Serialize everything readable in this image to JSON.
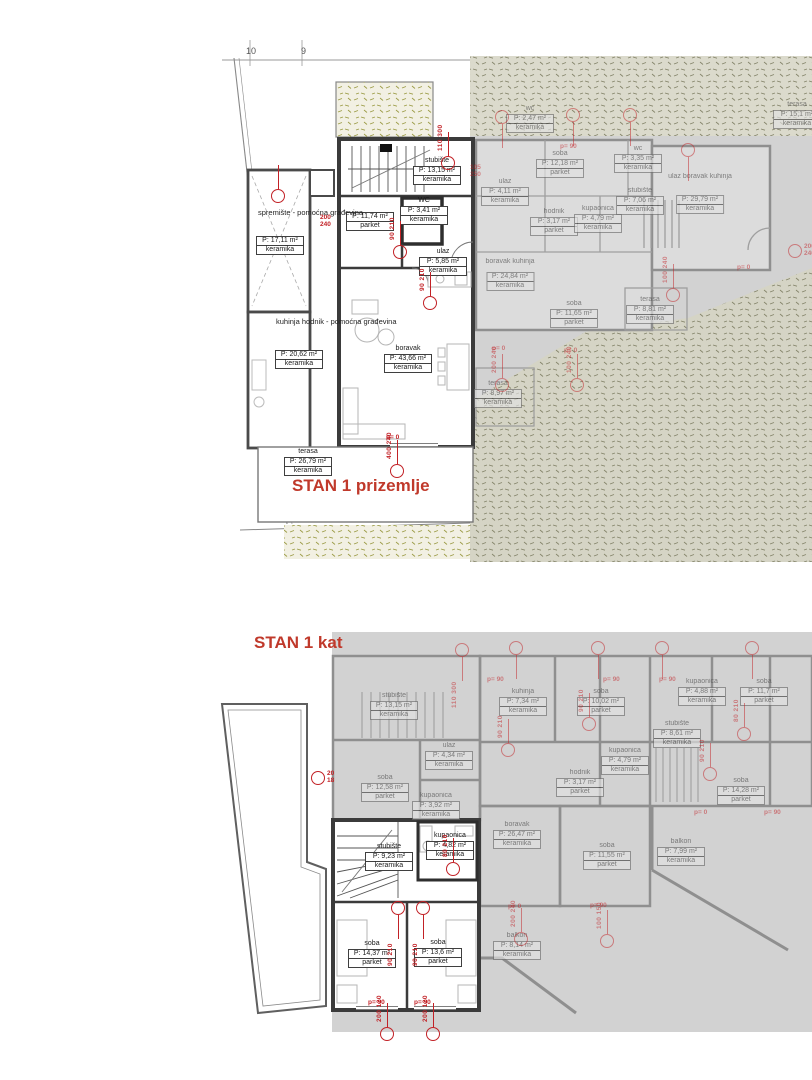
{
  "colors": {
    "accent_red": "#c22126",
    "title_red": "#c0392b",
    "gray_overlay": "#d2d2d2",
    "terrain_dot": "#9b9b45"
  },
  "grid_labels": [
    {
      "t": "10",
      "x": 250,
      "y": 50
    },
    {
      "t": "9",
      "x": 303,
      "y": 50
    }
  ],
  "floors": [
    {
      "id": "ground",
      "title": "STAN 1 prizemlje",
      "annotations": [
        {
          "t": "spremište - pomoćna građevina",
          "x": 258,
          "y": 208
        },
        {
          "t": "kuhinja hodnik - pomoćna građevina",
          "x": 276,
          "y": 317
        }
      ],
      "rooms": [
        {
          "name": "",
          "area": "P: 17,11 m²",
          "finish": "keramika",
          "cx": 280,
          "y": 236
        },
        {
          "name": "",
          "area": "P: 20,62 m²",
          "finish": "keramika",
          "cx": 299,
          "y": 350
        },
        {
          "name": "stubište",
          "area": "P: 13,15 m²",
          "finish": "keramika",
          "cx": 437,
          "y": 157
        },
        {
          "name": "WC",
          "area": "P: 3,41 m²",
          "finish": "keramika",
          "cx": 424,
          "y": 197
        },
        {
          "name": "",
          "area": "P: 11,74 m²",
          "finish": "parket",
          "cx": 370,
          "y": 212
        },
        {
          "name": "ulaz",
          "area": "P: 5,85 m²",
          "finish": "keramika",
          "cx": 443,
          "y": 248
        },
        {
          "name": "boravak",
          "area": "P: 43,66 m²",
          "finish": "keramika",
          "cx": 408,
          "y": 345
        },
        {
          "name": "terasa",
          "area": "P: 26,79 m²",
          "finish": "keramika",
          "cx": 308,
          "y": 448
        },
        {
          "name": "wc",
          "area": "P: 2,47 m²",
          "finish": "keramika",
          "cx": 530,
          "y": 105,
          "faded": true
        },
        {
          "name": "soba",
          "area": "P: 12,18 m²",
          "finish": "parket",
          "cx": 560,
          "y": 150,
          "faded": true
        },
        {
          "name": "ulaz",
          "area": "P: 4,11 m²",
          "finish": "keramika",
          "cx": 505,
          "y": 178,
          "faded": true
        },
        {
          "name": "hodnik",
          "area": "P: 3,17 m²",
          "finish": "parket",
          "cx": 554,
          "y": 208,
          "faded": true
        },
        {
          "name": "kupaonica",
          "area": "P: 4,79 m²",
          "finish": "keramika",
          "cx": 598,
          "y": 205,
          "faded": true
        },
        {
          "name": "wc",
          "area": "P: 3,35 m²",
          "finish": "keramika",
          "cx": 638,
          "y": 145,
          "faded": true
        },
        {
          "name": "stubište",
          "area": "P: 7,06 m²",
          "finish": "keramika",
          "cx": 640,
          "y": 187,
          "faded": true
        },
        {
          "name": "ulaz boravak kuhinja",
          "area": "P: 29,79 m²",
          "finish": "keramika",
          "cx": 700,
          "y": 173,
          "faded": true,
          "box_dy": 14
        },
        {
          "name": "terasa",
          "area": "P: 15,1 m²",
          "finish": "keramika",
          "cx": 797,
          "y": 101,
          "faded": true
        },
        {
          "name": "boravak kuhinja",
          "area": "P: 24,84 m²",
          "finish": "keramika",
          "cx": 510,
          "y": 258,
          "faded": true,
          "box_dy": 6
        },
        {
          "name": "soba",
          "area": "P: 11,65 m²",
          "finish": "parket",
          "cx": 574,
          "y": 300,
          "faded": true
        },
        {
          "name": "terasa",
          "area": "P: 8,81 m²",
          "finish": "keramika",
          "cx": 650,
          "y": 296,
          "faded": true
        },
        {
          "name": "terasa",
          "area": "P: 8,97 m²",
          "finish": "keramika",
          "cx": 498,
          "y": 380,
          "faded": true
        }
      ],
      "markers": [
        {
          "x": 448,
          "y": 163,
          "t": "110/300"
        },
        {
          "x": 400,
          "y": 252,
          "t": "90/210"
        },
        {
          "x": 430,
          "y": 303,
          "t": "90/210"
        },
        {
          "x": 397,
          "y": 471,
          "t": "400/240"
        },
        {
          "x": 278,
          "y": 196,
          "t": ""
        },
        {
          "x": 320,
          "y": 222,
          "t": "200/240",
          "stack": true,
          "circle": false
        },
        {
          "x": 470,
          "y": 172,
          "t": "105/250",
          "stack": true,
          "circle": false,
          "faded": true
        },
        {
          "x": 502,
          "y": 117,
          "t": "",
          "faded": true,
          "dir": "down"
        },
        {
          "x": 573,
          "y": 115,
          "t": "",
          "faded": true,
          "dir": "down"
        },
        {
          "x": 630,
          "y": 115,
          "t": "",
          "faded": true,
          "dir": "down"
        },
        {
          "x": 688,
          "y": 150,
          "t": "",
          "faded": true,
          "dir": "down"
        },
        {
          "x": 673,
          "y": 295,
          "t": "100/240",
          "faded": true
        },
        {
          "x": 795,
          "y": 251,
          "t": "200/240",
          "stack": true,
          "faded": true
        },
        {
          "x": 502,
          "y": 385,
          "t": "200/240",
          "faded": true
        },
        {
          "x": 577,
          "y": 385,
          "t": "100/240",
          "faded": true
        }
      ],
      "ptexts": [
        {
          "t": "p= 0",
          "x": 386,
          "y": 434
        },
        {
          "t": "p= 90",
          "x": 560,
          "y": 143,
          "faded": true
        },
        {
          "t": "p= 0",
          "x": 737,
          "y": 264,
          "faded": true
        },
        {
          "t": "p= 0",
          "x": 492,
          "y": 345,
          "faded": true
        },
        {
          "t": "p= 0",
          "x": 564,
          "y": 347,
          "faded": true
        }
      ]
    },
    {
      "id": "first",
      "title": "STAN 1 kat",
      "annotations": [],
      "rooms": [
        {
          "name": "stubište",
          "area": "P: 13,15 m²",
          "finish": "keramika",
          "cx": 394,
          "y": 692,
          "faded": true
        },
        {
          "name": "ulaz",
          "area": "P: 4,34 m²",
          "finish": "keramika",
          "cx": 449,
          "y": 742,
          "faded": true
        },
        {
          "name": "soba",
          "area": "P: 12,58 m²",
          "finish": "parket",
          "cx": 385,
          "y": 774,
          "faded": true
        },
        {
          "name": "kupaonica",
          "area": "P: 3,92 m²",
          "finish": "keramika",
          "cx": 436,
          "y": 792,
          "faded": true
        },
        {
          "name": "kuhinja",
          "area": "P: 7,34 m²",
          "finish": "keramika",
          "cx": 523,
          "y": 688,
          "faded": true
        },
        {
          "name": "soba",
          "area": "P: 10,02 m²",
          "finish": "parket",
          "cx": 601,
          "y": 688,
          "faded": true
        },
        {
          "name": "kupaonica",
          "area": "P: 4,79 m²",
          "finish": "keramika",
          "cx": 625,
          "y": 747,
          "faded": true
        },
        {
          "name": "hodnik",
          "area": "P: 3,17 m²",
          "finish": "parket",
          "cx": 580,
          "y": 769,
          "faded": true
        },
        {
          "name": "kupaonica",
          "area": "P: 4,88 m²",
          "finish": "keramika",
          "cx": 702,
          "y": 678,
          "faded": true
        },
        {
          "name": "soba",
          "area": "P: 11,7 m²",
          "finish": "parket",
          "cx": 764,
          "y": 678,
          "faded": true
        },
        {
          "name": "stubište",
          "area": "P: 8,61 m²",
          "finish": "keramika",
          "cx": 677,
          "y": 720,
          "faded": true
        },
        {
          "name": "soba",
          "area": "P: 14,28 m²",
          "finish": "parket",
          "cx": 741,
          "y": 777,
          "faded": true
        },
        {
          "name": "boravak",
          "area": "P: 26,47 m²",
          "finish": "keramika",
          "cx": 517,
          "y": 821,
          "faded": true
        },
        {
          "name": "soba",
          "area": "P: 11,55 m²",
          "finish": "parket",
          "cx": 607,
          "y": 842,
          "faded": true
        },
        {
          "name": "balkon",
          "area": "P: 8,14 m²",
          "finish": "keramika",
          "cx": 517,
          "y": 932,
          "faded": true
        },
        {
          "name": "balkon",
          "area": "P: 7,99 m²",
          "finish": "keramika",
          "cx": 681,
          "y": 838,
          "faded": true
        },
        {
          "name": "stubište",
          "area": "P: 9,23 m²",
          "finish": "keramika",
          "cx": 389,
          "y": 843
        },
        {
          "name": "kupaonica",
          "area": "P: 4,82 m²",
          "finish": "keramika",
          "cx": 450,
          "y": 832
        },
        {
          "name": "soba",
          "area": "P: 14,37 m²",
          "finish": "parket",
          "cx": 372,
          "y": 940
        },
        {
          "name": "soba",
          "area": "P: 13,6 m²",
          "finish": "parket",
          "cx": 438,
          "y": 939
        }
      ],
      "markers": [
        {
          "x": 462,
          "y": 650,
          "t": "110/300",
          "faded": true,
          "dir": "down"
        },
        {
          "x": 516,
          "y": 648,
          "t": "",
          "faded": true,
          "dir": "down"
        },
        {
          "x": 598,
          "y": 648,
          "t": "",
          "faded": true,
          "dir": "down"
        },
        {
          "x": 662,
          "y": 648,
          "t": "",
          "faded": true,
          "dir": "down"
        },
        {
          "x": 752,
          "y": 648,
          "t": "",
          "faded": true,
          "dir": "down"
        },
        {
          "x": 318,
          "y": 778,
          "t": "20/18",
          "stack": true
        },
        {
          "x": 508,
          "y": 750,
          "t": "90/210",
          "faded": true
        },
        {
          "x": 589,
          "y": 724,
          "t": "90/210",
          "faded": true
        },
        {
          "x": 744,
          "y": 734,
          "t": "80/210",
          "faded": true
        },
        {
          "x": 710,
          "y": 774,
          "t": "90/210",
          "faded": true
        },
        {
          "x": 398,
          "y": 908,
          "t": "90/210",
          "dir": "down"
        },
        {
          "x": 423,
          "y": 908,
          "t": "90/210",
          "dir": "down"
        },
        {
          "x": 453,
          "y": 869,
          "t": "80/210"
        },
        {
          "x": 387,
          "y": 1034,
          "t": "200/120"
        },
        {
          "x": 433,
          "y": 1034,
          "t": "200/120"
        },
        {
          "x": 521,
          "y": 939,
          "t": "200/240",
          "faded": true
        },
        {
          "x": 607,
          "y": 941,
          "t": "100/150",
          "faded": true
        }
      ],
      "ptexts": [
        {
          "t": "p= 90",
          "x": 487,
          "y": 676,
          "faded": true
        },
        {
          "t": "p= 90",
          "x": 603,
          "y": 676,
          "faded": true
        },
        {
          "t": "p= 90",
          "x": 659,
          "y": 676,
          "faded": true
        },
        {
          "t": "p= 0",
          "x": 508,
          "y": 903,
          "faded": true
        },
        {
          "t": "p= 90",
          "x": 590,
          "y": 902,
          "faded": true
        },
        {
          "t": "p= 0",
          "x": 694,
          "y": 809,
          "faded": true
        },
        {
          "t": "p= 90",
          "x": 764,
          "y": 809,
          "faded": true
        },
        {
          "t": "p= 90",
          "x": 368,
          "y": 999
        },
        {
          "t": "p= 90",
          "x": 414,
          "y": 999
        }
      ]
    }
  ]
}
